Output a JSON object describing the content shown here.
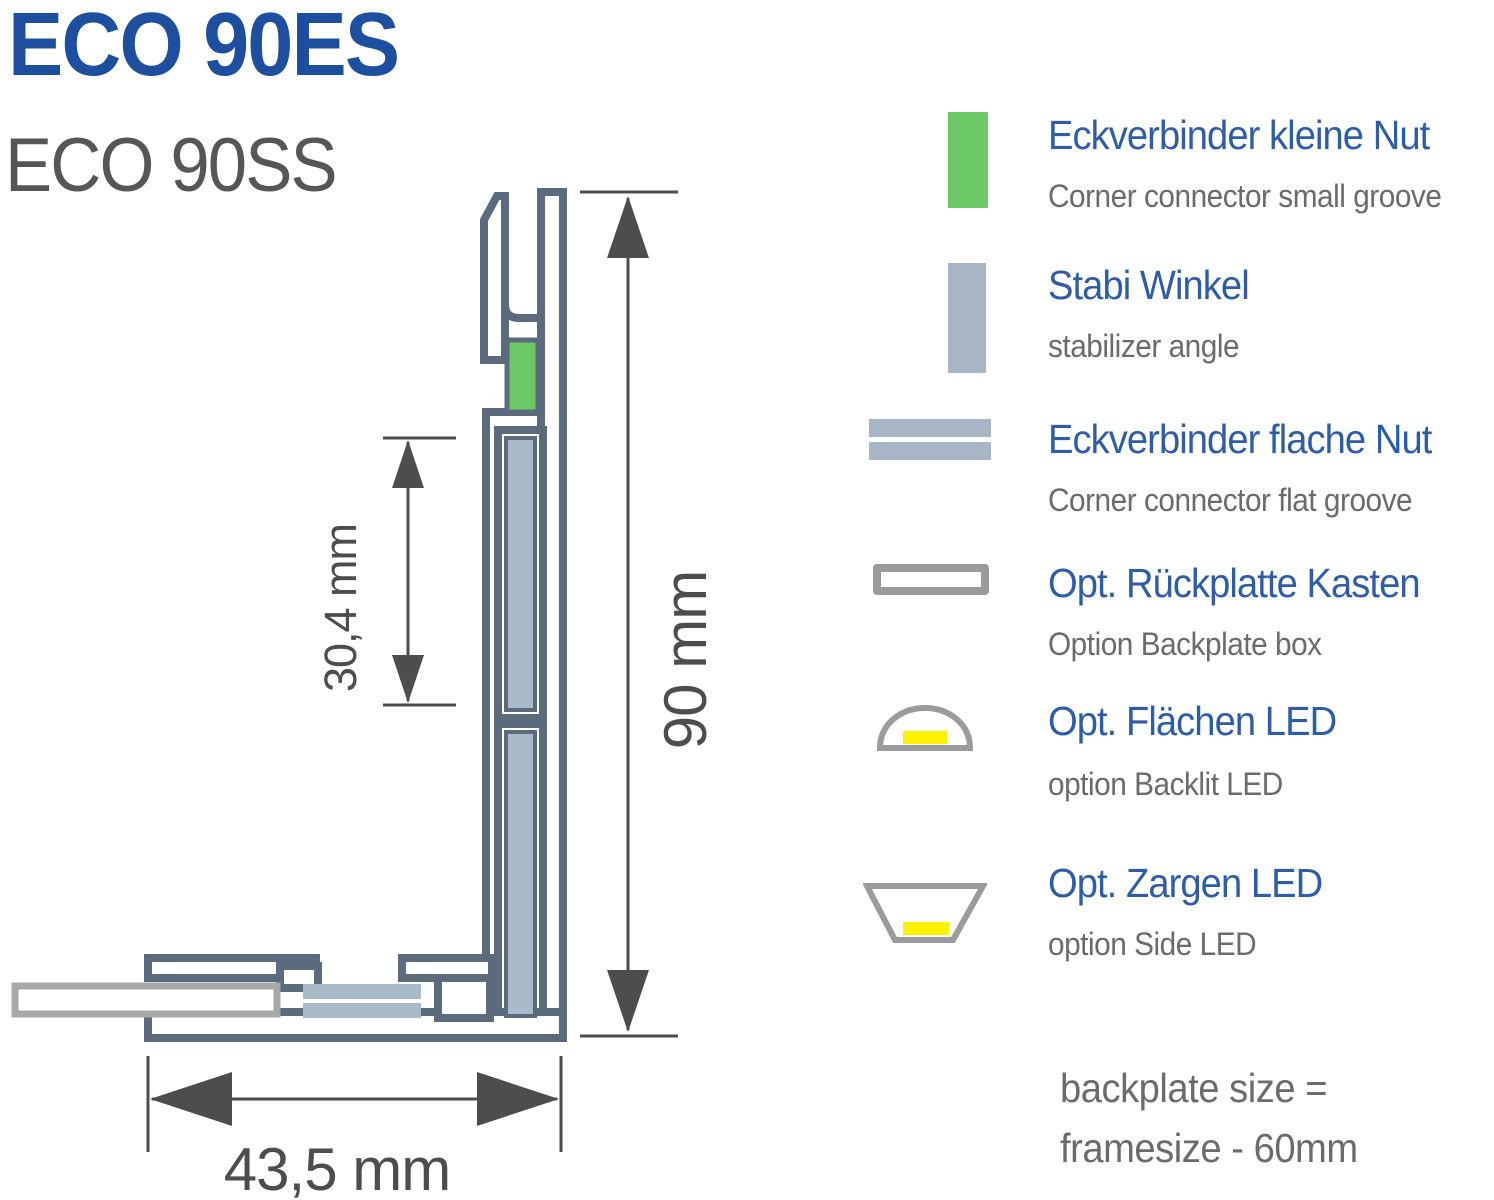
{
  "page": {
    "title": "ECO 90ES",
    "subtitle": "ECO 90SS"
  },
  "diagram": {
    "dim_height": "90 mm",
    "dim_groove": "30,4 mm",
    "dim_width": "43,5 mm"
  },
  "legend": {
    "items": [
      {
        "label_de": "Eckverbinder kleine Nut",
        "label_en": "Corner connector small groove",
        "icon": "green-connector-swatch",
        "color": "#6cc765"
      },
      {
        "label_de": "Stabi Winkel",
        "label_en": "stabilizer angle",
        "icon": "stabilizer-swatch",
        "color": "#a7b5c4"
      },
      {
        "label_de": "Eckverbinder flache Nut",
        "label_en": "Corner connector flat groove",
        "icon": "double-bars-swatch",
        "color": "#a7b5c4"
      },
      {
        "label_de": "Opt. Rückplatte Kasten",
        "label_en": "Option Backplate box",
        "icon": "outline-box-swatch",
        "color": "#9b9b9b"
      },
      {
        "label_de": "Opt. Flächen LED",
        "label_en": "option Backlit LED",
        "icon": "dome-led-swatch",
        "color": "#fff200"
      },
      {
        "label_de": "Opt. Zargen LED",
        "label_en": "option Side LED",
        "icon": "trapezoid-led-swatch",
        "color": "#fff200"
      }
    ]
  },
  "note": {
    "line1": "backplate size =",
    "line2": "framesize - 60mm"
  },
  "colors": {
    "title_blue": "#1d4f9e",
    "legend_heading_blue": "#2e5ca6",
    "text_gray": "#6b6b6b",
    "profile_outline": "#5b6b7d",
    "stabilizer_fill": "#a9bac9",
    "connector_green": "#6cc765",
    "backplate_outline": "#a8a8a8",
    "led_yellow": "#fff200",
    "dimension_gray": "#4d4d4d"
  }
}
